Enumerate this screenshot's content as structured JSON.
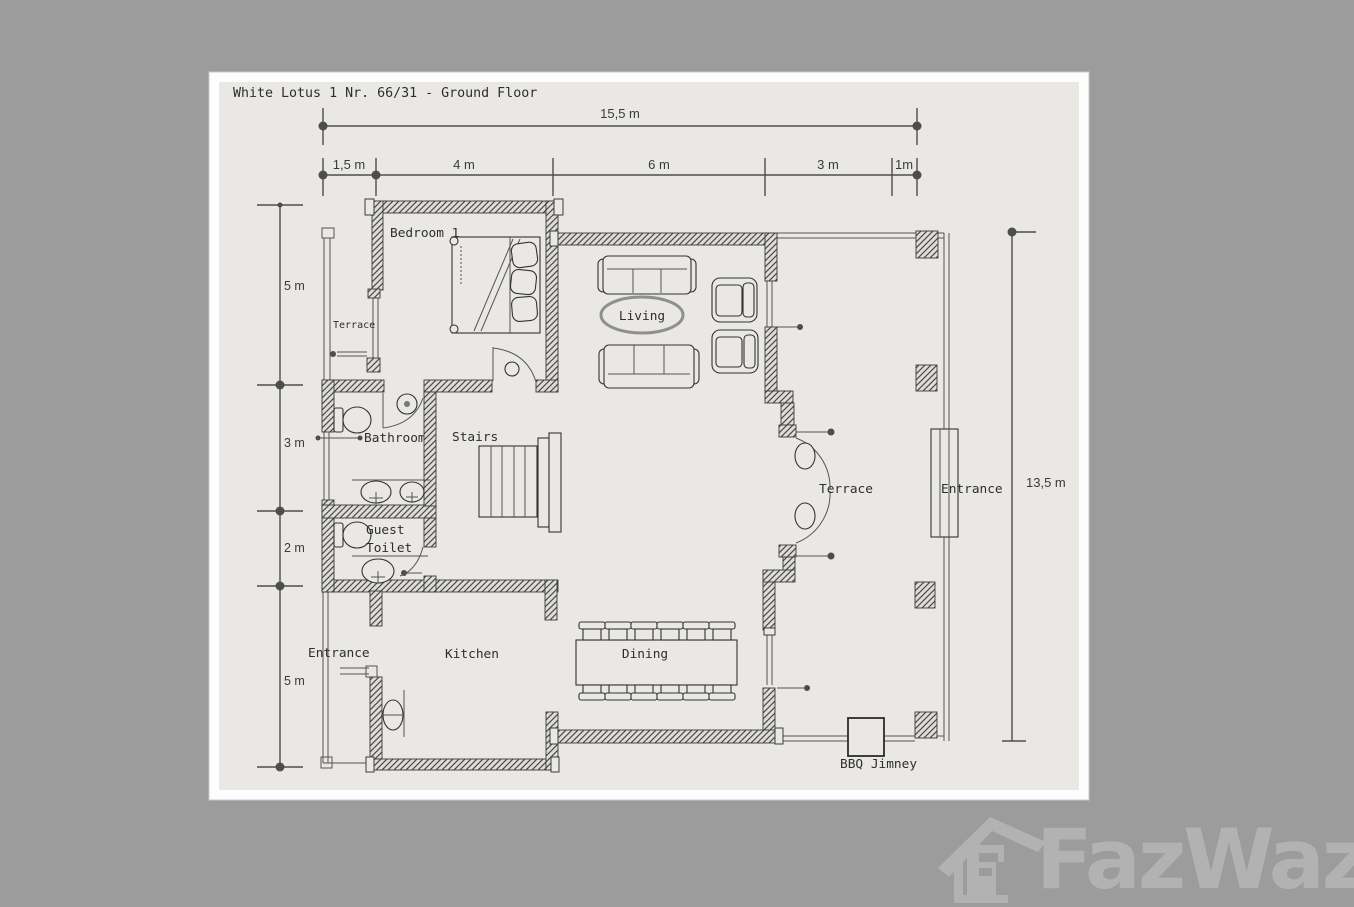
{
  "page": {
    "title": "White Lotus 1 Nr. 66/31 - Ground Floor"
  },
  "dimensions": {
    "total_width": "15,5 m",
    "width_segments": [
      "1,5 m",
      "4 m",
      "6 m",
      "3 m",
      "1m"
    ],
    "left_heights": [
      "5 m",
      "3 m",
      "2 m",
      "5 m"
    ],
    "total_height": "13,5 m"
  },
  "rooms": {
    "bedroom": "Bedroom 1",
    "terrace_left": "Terrace",
    "living": "Living",
    "bathroom": "Bathroom",
    "stairs": "Stairs",
    "guest_toilet_line1": "Guest",
    "guest_toilet_line2": "Toilet",
    "terrace_right": "Terrace",
    "entrance_right": "Entrance",
    "entrance_left": "Entrance",
    "kitchen": "Kitchen",
    "dining": "Dining",
    "bbq": "BBQ Jimney"
  },
  "watermark": {
    "brand": "FazWaz"
  },
  "colors": {
    "canvas_bg": "#9c9c9c",
    "page_bg": "#e9e8e5",
    "line": "#4d4d4d",
    "watermark": "#b2b2b2"
  }
}
